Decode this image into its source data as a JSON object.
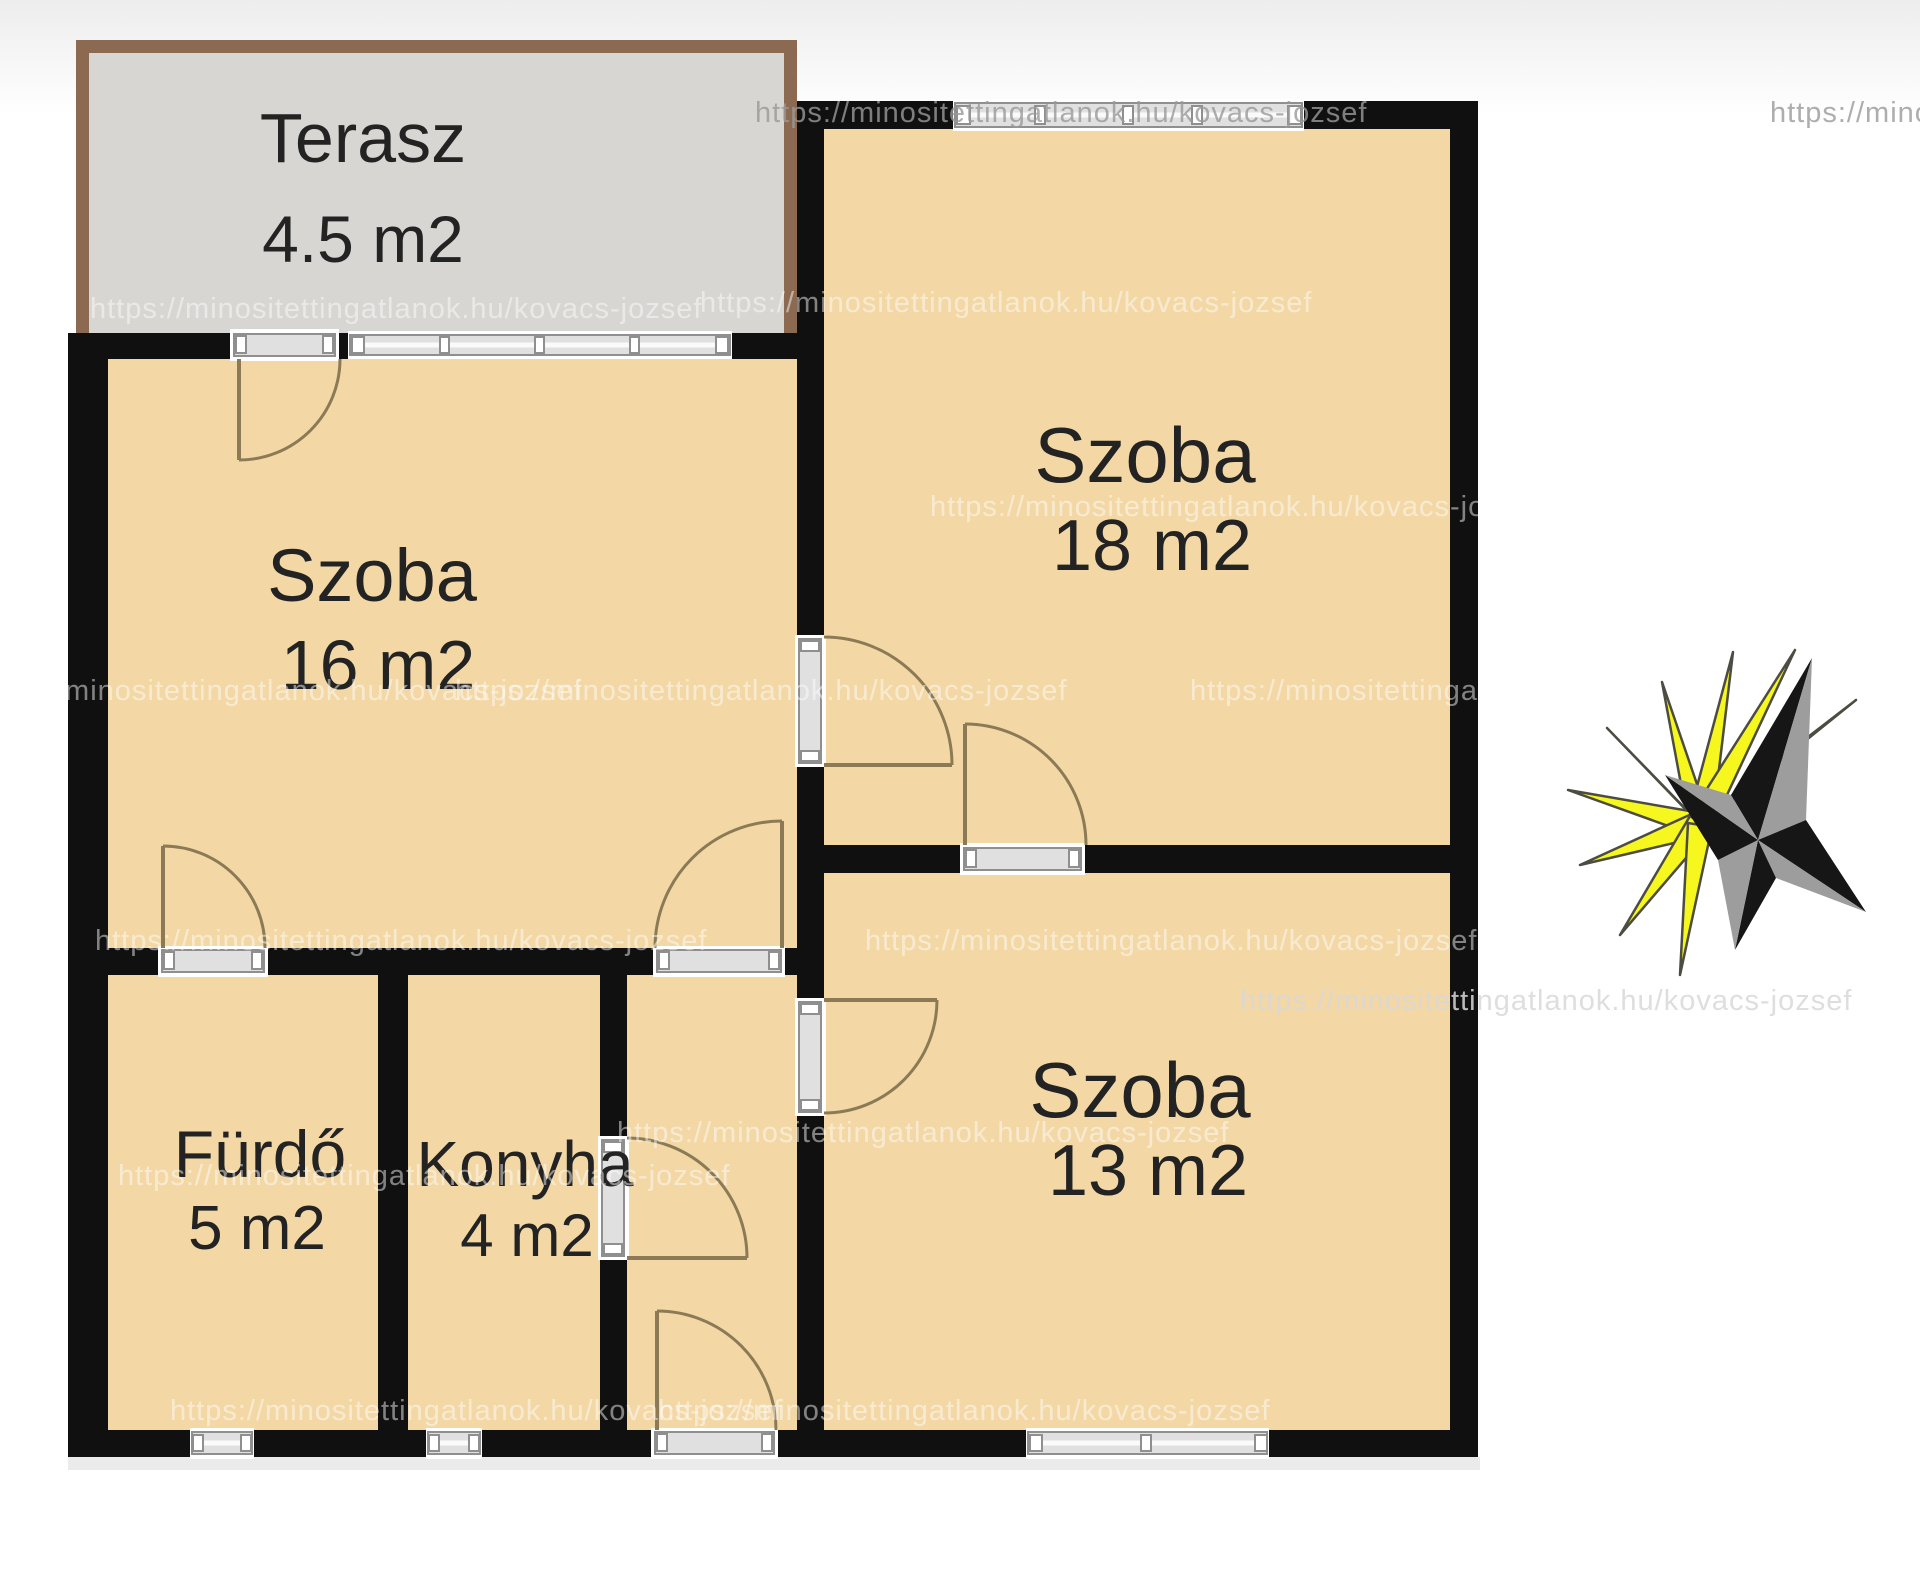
{
  "floor_plan": {
    "watermark_url": "https://minositettingatlanok.hu/kovacs-jozsef",
    "rooms": [
      {
        "id": "terasz",
        "name": "Terasz",
        "area": "4.5 m2"
      },
      {
        "id": "szoba-16",
        "name": "Szoba",
        "area": "16 m2"
      },
      {
        "id": "szoba-18",
        "name": "Szoba",
        "area": "18 m2"
      },
      {
        "id": "szoba-13",
        "name": "Szoba",
        "area": "13 m2"
      },
      {
        "id": "furdo",
        "name": "Fürdő",
        "area": "5 m2"
      },
      {
        "id": "konyha",
        "name": "Konyha",
        "area": "4 m2"
      }
    ],
    "colors": {
      "wall": "#101010",
      "room_fill": "#f3d8a6",
      "terrace_fill": "#d7d6d3",
      "terrace_border": "#8c6a52",
      "opening_fill": "#e0e0e0",
      "opening_stroke": "#8f8f8f",
      "door_arc": "#8b7a55",
      "label": "#232323",
      "watermark_gray": "#9a9a9a",
      "watermark_light": "#ffffff",
      "compass_yellow": "#f7f720",
      "compass_outline": "#4c4c42",
      "compass_dark": "#161616",
      "compass_gray": "#9d9d9d"
    }
  }
}
